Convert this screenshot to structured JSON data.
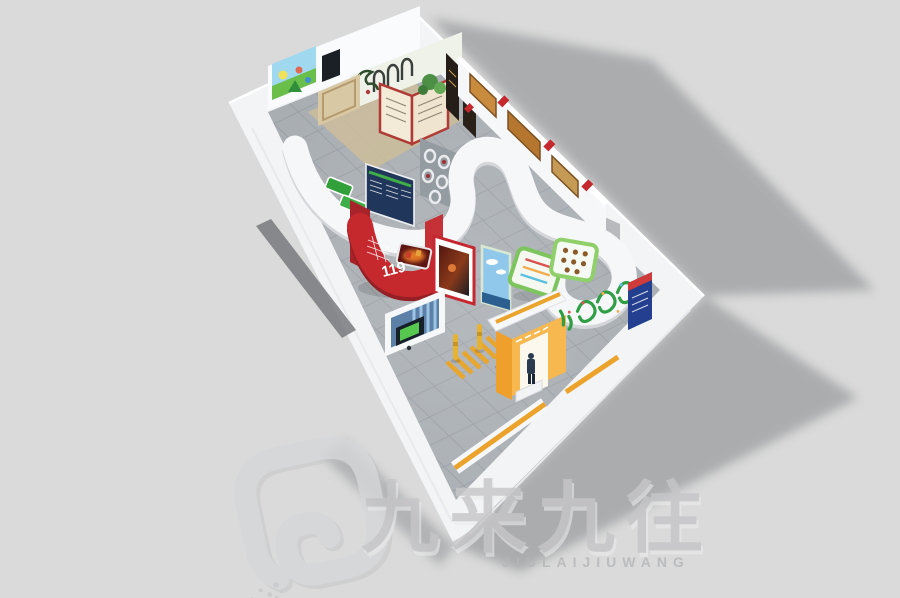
{
  "image": {
    "kind": "3D isometric bird's-eye rendering of a fire-safety education exhibition hall",
    "background_color": "#dadada"
  },
  "palette": {
    "wall_white": "#f3f4f6",
    "wall_shade": "#e4e6ea",
    "floor_gray": "#a9aeb3",
    "floor_grid": "#969ca2",
    "cast_shadow": "#7e8083",
    "theme_red": "#c5292e",
    "navy_blue": "#20365a",
    "leaf_green": "#3fae49",
    "frame_green": "#7cc45c",
    "accent_orange": "#efa02c",
    "stripe_blue": "#9cc4e4",
    "wood_beige": "#d9c8a4"
  },
  "hall": {
    "reception_sign": "119",
    "elements": [
      "s-curve-partition-walls",
      "red-reception-desk-119",
      "cartoon-safety-mural",
      "open-book-display",
      "history-photo-wall",
      "circular-niche-wall",
      "green-framed-exhibit-boards",
      "blue-striped-kiosk-alcove",
      "pedestrian-crossing-floor-markings",
      "yellow-bollards",
      "orange-entrance-gate-with-figure"
    ]
  },
  "watermark": {
    "logo_glyph": "rounded-square-spiral-with-dissolving-dots",
    "text_cn": "九来九往",
    "text_en": "JIULAIJIUWANG"
  }
}
